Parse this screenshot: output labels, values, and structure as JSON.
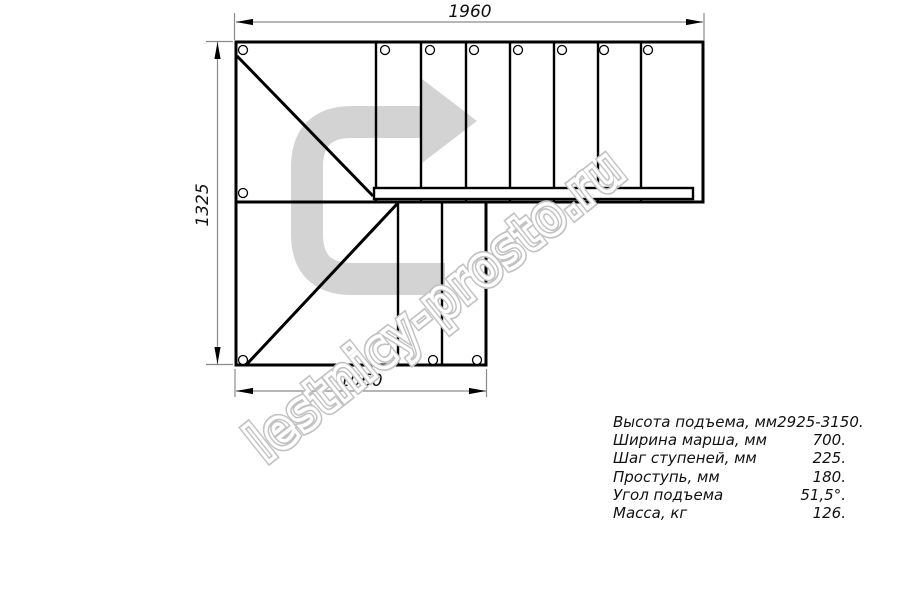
{
  "watermark": "lestnicy-prosto.ru",
  "dimensions": {
    "top": "1960",
    "left": "1325",
    "bottom": "1060"
  },
  "specs": {
    "rows": [
      {
        "label": "Высота подъема, мм",
        "value": "2925-3150."
      },
      {
        "label": "Ширина марша, мм",
        "value": "700."
      },
      {
        "label": "Шаг ступеней, мм",
        "value": "225."
      },
      {
        "label": "Проступь, мм",
        "value": "180."
      },
      {
        "label": "Угол подъема",
        "value": "51,5°."
      },
      {
        "label": "Масса, кг",
        "value": "126."
      }
    ]
  },
  "icons": {
    "direction_arrow": "u-turn-direction-arrow"
  },
  "colors": {
    "line": "#000000",
    "dimension_line": "#8a8a8a",
    "arrow_fill": "#d3d3d3",
    "watermark_outline": "#c2c2c2",
    "background": "#ffffff"
  }
}
